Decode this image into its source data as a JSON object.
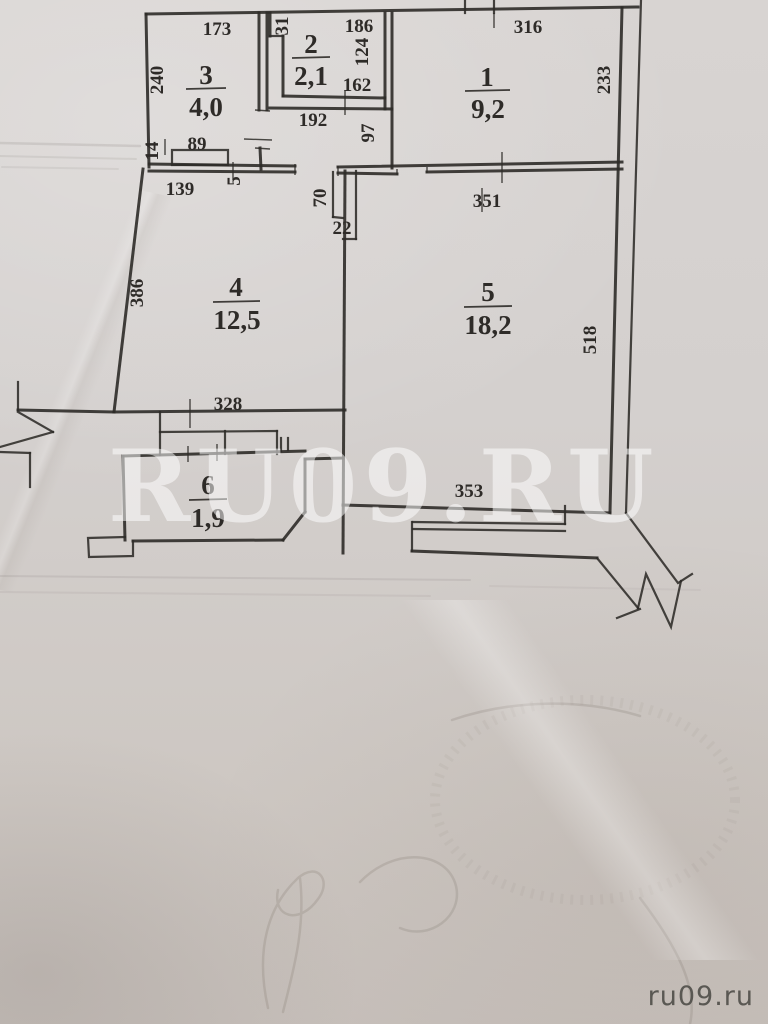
{
  "document": {
    "type": "apartment floor plan photo"
  },
  "rooms": [
    {
      "number": "1",
      "area": "9,2",
      "dims": {
        "top": "316",
        "right": "233"
      }
    },
    {
      "number": "2",
      "area": "2,1",
      "dims": {
        "left": "31",
        "top": "186",
        "right": "124",
        "bottom": "162"
      }
    },
    {
      "number": "3",
      "area": "4,0",
      "dims": {
        "top": "173",
        "left": "240",
        "niche_width": "89",
        "niche_depth": "14"
      }
    },
    {
      "number": "4",
      "area": "12,5",
      "dims": {
        "left": "386",
        "top_left": "139",
        "top_step": "5",
        "bottom": "328"
      }
    },
    {
      "number": "5",
      "area": "18,2",
      "dims": {
        "top": "351",
        "right": "518",
        "bottom": "353"
      }
    },
    {
      "number": "6",
      "area": "1,9",
      "dims": {}
    }
  ],
  "corridor": {
    "width": "192",
    "side_wall": "97"
  },
  "shaft": {
    "height": "70",
    "width": "22"
  },
  "watermark": {
    "center": "RU09.RU",
    "corner": "ru09.ru"
  },
  "colors": {
    "paper": "#d4d0ce",
    "ink": "#2e2b28",
    "watermark": "#ffffff"
  }
}
